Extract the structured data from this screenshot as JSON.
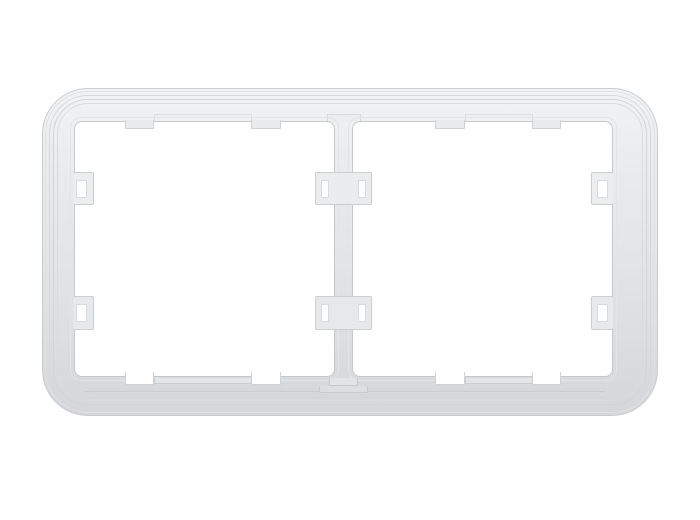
{
  "scene": {
    "subject": "two-gang wall switch mounting frame, light gray translucent plastic, front view on white background",
    "background_color": "#ffffff",
    "palette": {
      "frame_light": "#f2f3f4",
      "frame_mid": "#e4e6e8",
      "frame_dark": "#d4d6d8",
      "ridge_line": "#d2d4d6",
      "edge_line": "#c6c8ca",
      "opening_fill": "#ffffff"
    },
    "parts": [
      {
        "name": "frame-outer",
        "x": 42,
        "y": 88,
        "w": 616,
        "h": 328,
        "r": 46,
        "fill": "gradient",
        "stroke": "#c9cbcd",
        "sides": "all"
      },
      {
        "name": "frame-ridge-1",
        "x": 45,
        "y": 91,
        "w": 610,
        "h": 322,
        "r": 43,
        "fill": "none",
        "stroke": "#dee0e2",
        "sides": "all"
      },
      {
        "name": "frame-ridge-2",
        "x": 49,
        "y": 95,
        "w": 602,
        "h": 314,
        "r": 39,
        "fill": "none",
        "stroke": "#d6d8da",
        "sides": "all"
      },
      {
        "name": "frame-ridge-3",
        "x": 53,
        "y": 99,
        "w": 594,
        "h": 306,
        "r": 35,
        "fill": "none",
        "stroke": "#d2d4d6",
        "sides": "all"
      },
      {
        "name": "frame-ridge-4",
        "x": 57,
        "y": 103,
        "w": 586,
        "h": 298,
        "r": 31,
        "fill": "none",
        "stroke": "#d9dbdd",
        "sides": "all"
      },
      {
        "name": "top-recess-band-left",
        "x": 154,
        "y": 114,
        "w": 98,
        "h": 8,
        "r": 1,
        "fill": "#eff0f1",
        "stroke": "#dcdee0",
        "sides": "lrt"
      },
      {
        "name": "top-recess-band-right",
        "x": 465,
        "y": 114,
        "w": 68,
        "h": 8,
        "r": 1,
        "fill": "#eff0f1",
        "stroke": "#dcdee0",
        "sides": "lrt"
      },
      {
        "name": "divider-top-stub",
        "x": 327,
        "y": 114,
        "w": 34,
        "h": 8,
        "r": 1,
        "fill": "#ebedee",
        "stroke": "#d8dadc",
        "sides": "lrt"
      },
      {
        "name": "opening-bevel-left",
        "x": 70,
        "y": 117,
        "w": 269,
        "h": 264,
        "r": 11,
        "fill": "none",
        "stroke": "#e2e4e6",
        "sides": "all"
      },
      {
        "name": "opening-bevel-right",
        "x": 348,
        "y": 117,
        "w": 269,
        "h": 264,
        "r": 11,
        "fill": "none",
        "stroke": "#e2e4e6",
        "sides": "all"
      },
      {
        "name": "opening-left",
        "x": 74,
        "y": 121,
        "w": 261,
        "h": 256,
        "r": 8,
        "fill": "#ffffff",
        "stroke": "#c6c8ca",
        "sides": "all"
      },
      {
        "name": "opening-right",
        "x": 352,
        "y": 121,
        "w": 261,
        "h": 256,
        "r": 8,
        "fill": "#ffffff",
        "stroke": "#c6c8ca",
        "sides": "all"
      },
      {
        "name": "bottom-ledge-line-1",
        "x": 84,
        "y": 391,
        "w": 243,
        "h": 1,
        "r": 0,
        "fill": "#cbcdcf",
        "stroke": "none",
        "sides": "none"
      },
      {
        "name": "bottom-ledge-line-2",
        "x": 360,
        "y": 391,
        "w": 245,
        "h": 1,
        "r": 0,
        "fill": "#cbcdcf",
        "stroke": "none",
        "sides": "none"
      },
      {
        "name": "bottom-ledge-line-3",
        "x": 90,
        "y": 397,
        "w": 240,
        "h": 1,
        "r": 0,
        "fill": "#d0d2d4",
        "stroke": "none",
        "sides": "none"
      },
      {
        "name": "bottom-ledge-line-4",
        "x": 363,
        "y": 397,
        "w": 242,
        "h": 1,
        "r": 0,
        "fill": "#d0d2d4",
        "stroke": "none",
        "sides": "none"
      },
      {
        "name": "top-tab-left-1",
        "x": 125,
        "y": 120,
        "w": 29,
        "h": 9,
        "r": 1,
        "fill": "#e8eaeb",
        "stroke": "#cfd1d3",
        "sides": "lrb"
      },
      {
        "name": "top-tab-left-2",
        "x": 251,
        "y": 120,
        "w": 30,
        "h": 9,
        "r": 1,
        "fill": "#e8eaeb",
        "stroke": "#cfd1d3",
        "sides": "lrb"
      },
      {
        "name": "top-tab-right-1",
        "x": 435,
        "y": 120,
        "w": 30,
        "h": 9,
        "r": 1,
        "fill": "#e8eaeb",
        "stroke": "#cfd1d3",
        "sides": "lrb"
      },
      {
        "name": "top-tab-right-2",
        "x": 532,
        "y": 120,
        "w": 29,
        "h": 9,
        "r": 1,
        "fill": "#e8eaeb",
        "stroke": "#cfd1d3",
        "sides": "lrb"
      },
      {
        "name": "bottom-notch-left-1",
        "x": 125,
        "y": 372,
        "w": 29,
        "h": 13,
        "r": 0,
        "fill": "#fefefe",
        "stroke": "#cfd1d3",
        "sides": "lrb"
      },
      {
        "name": "bottom-notch-left-2",
        "x": 251,
        "y": 372,
        "w": 30,
        "h": 13,
        "r": 0,
        "fill": "#fefefe",
        "stroke": "#cfd1d3",
        "sides": "lrb"
      },
      {
        "name": "bottom-notch-right-1",
        "x": 435,
        "y": 372,
        "w": 30,
        "h": 13,
        "r": 0,
        "fill": "#fefefe",
        "stroke": "#cfd1d3",
        "sides": "lrb"
      },
      {
        "name": "bottom-notch-right-2",
        "x": 532,
        "y": 372,
        "w": 29,
        "h": 13,
        "r": 0,
        "fill": "#fefefe",
        "stroke": "#cfd1d3",
        "sides": "lrb"
      },
      {
        "name": "bottom-step-left",
        "x": 154,
        "y": 378,
        "w": 98,
        "h": 6,
        "r": 0,
        "fill": "#e3e5e6",
        "stroke": "#cbcdcf",
        "sides": "lrb"
      },
      {
        "name": "bottom-step-right",
        "x": 465,
        "y": 378,
        "w": 68,
        "h": 6,
        "r": 0,
        "fill": "#e3e5e6",
        "stroke": "#cbcdcf",
        "sides": "lrb"
      },
      {
        "name": "divider-foot-step-1",
        "x": 329,
        "y": 378,
        "w": 29,
        "h": 8,
        "r": 0,
        "fill": "#e1e3e4",
        "stroke": "#c6c8ca",
        "sides": "lrb"
      },
      {
        "name": "divider-foot-step-2",
        "x": 319,
        "y": 386,
        "w": 49,
        "h": 7,
        "r": 1,
        "fill": "#dcdee0",
        "stroke": "#c9cbcd",
        "sides": "lrb"
      },
      {
        "name": "clip-tab-left-upper",
        "x": 73,
        "y": 172,
        "w": 21,
        "h": 33,
        "r": 2,
        "fill": "#ebedee",
        "stroke": "#ccced0",
        "sides": "trb"
      },
      {
        "name": "clip-window-left-upper",
        "x": 76,
        "y": 180,
        "w": 11,
        "h": 18,
        "r": 1,
        "fill": "#fdfdfd",
        "stroke": "#d8dadc",
        "sides": "all"
      },
      {
        "name": "clip-tab-left-lower",
        "x": 73,
        "y": 296,
        "w": 21,
        "h": 34,
        "r": 2,
        "fill": "#e7e9ea",
        "stroke": "#ccced0",
        "sides": "trb"
      },
      {
        "name": "clip-window-left-lower",
        "x": 76,
        "y": 304,
        "w": 11,
        "h": 18,
        "r": 1,
        "fill": "#fdfdfd",
        "stroke": "#d8dadc",
        "sides": "all"
      },
      {
        "name": "clip-tab-right-upper",
        "x": 591,
        "y": 172,
        "w": 22,
        "h": 33,
        "r": 2,
        "fill": "#ebedee",
        "stroke": "#ccced0",
        "sides": "tlb"
      },
      {
        "name": "clip-window-right-upper",
        "x": 597,
        "y": 180,
        "w": 11,
        "h": 18,
        "r": 1,
        "fill": "#fdfdfd",
        "stroke": "#d8dadc",
        "sides": "all"
      },
      {
        "name": "clip-tab-right-lower",
        "x": 591,
        "y": 296,
        "w": 22,
        "h": 34,
        "r": 2,
        "fill": "#e7e9ea",
        "stroke": "#ccced0",
        "sides": "tlb"
      },
      {
        "name": "clip-window-right-lower",
        "x": 597,
        "y": 304,
        "w": 11,
        "h": 18,
        "r": 1,
        "fill": "#fdfdfd",
        "stroke": "#d8dadc",
        "sides": "all"
      },
      {
        "name": "divider-clip-upper",
        "x": 315,
        "y": 172,
        "w": 57,
        "h": 33,
        "r": 2,
        "fill": "#eaecee",
        "stroke": "#ccced0",
        "sides": "all"
      },
      {
        "name": "divider-clip-upper-window-left",
        "x": 321,
        "y": 180,
        "w": 8,
        "h": 18,
        "r": 1,
        "fill": "#fdfdfd",
        "stroke": "#d8dadc",
        "sides": "all"
      },
      {
        "name": "divider-clip-upper-window-right",
        "x": 358,
        "y": 180,
        "w": 8,
        "h": 18,
        "r": 1,
        "fill": "#fdfdfd",
        "stroke": "#d8dadc",
        "sides": "all"
      },
      {
        "name": "divider-clip-lower",
        "x": 315,
        "y": 296,
        "w": 57,
        "h": 34,
        "r": 2,
        "fill": "#e6e8ea",
        "stroke": "#ccced0",
        "sides": "all"
      },
      {
        "name": "divider-clip-lower-window-left",
        "x": 321,
        "y": 304,
        "w": 8,
        "h": 18,
        "r": 1,
        "fill": "#fdfdfd",
        "stroke": "#d8dadc",
        "sides": "all"
      },
      {
        "name": "divider-clip-lower-window-right",
        "x": 358,
        "y": 304,
        "w": 8,
        "h": 18,
        "r": 1,
        "fill": "#fdfdfd",
        "stroke": "#d8dadc",
        "sides": "all"
      }
    ]
  }
}
